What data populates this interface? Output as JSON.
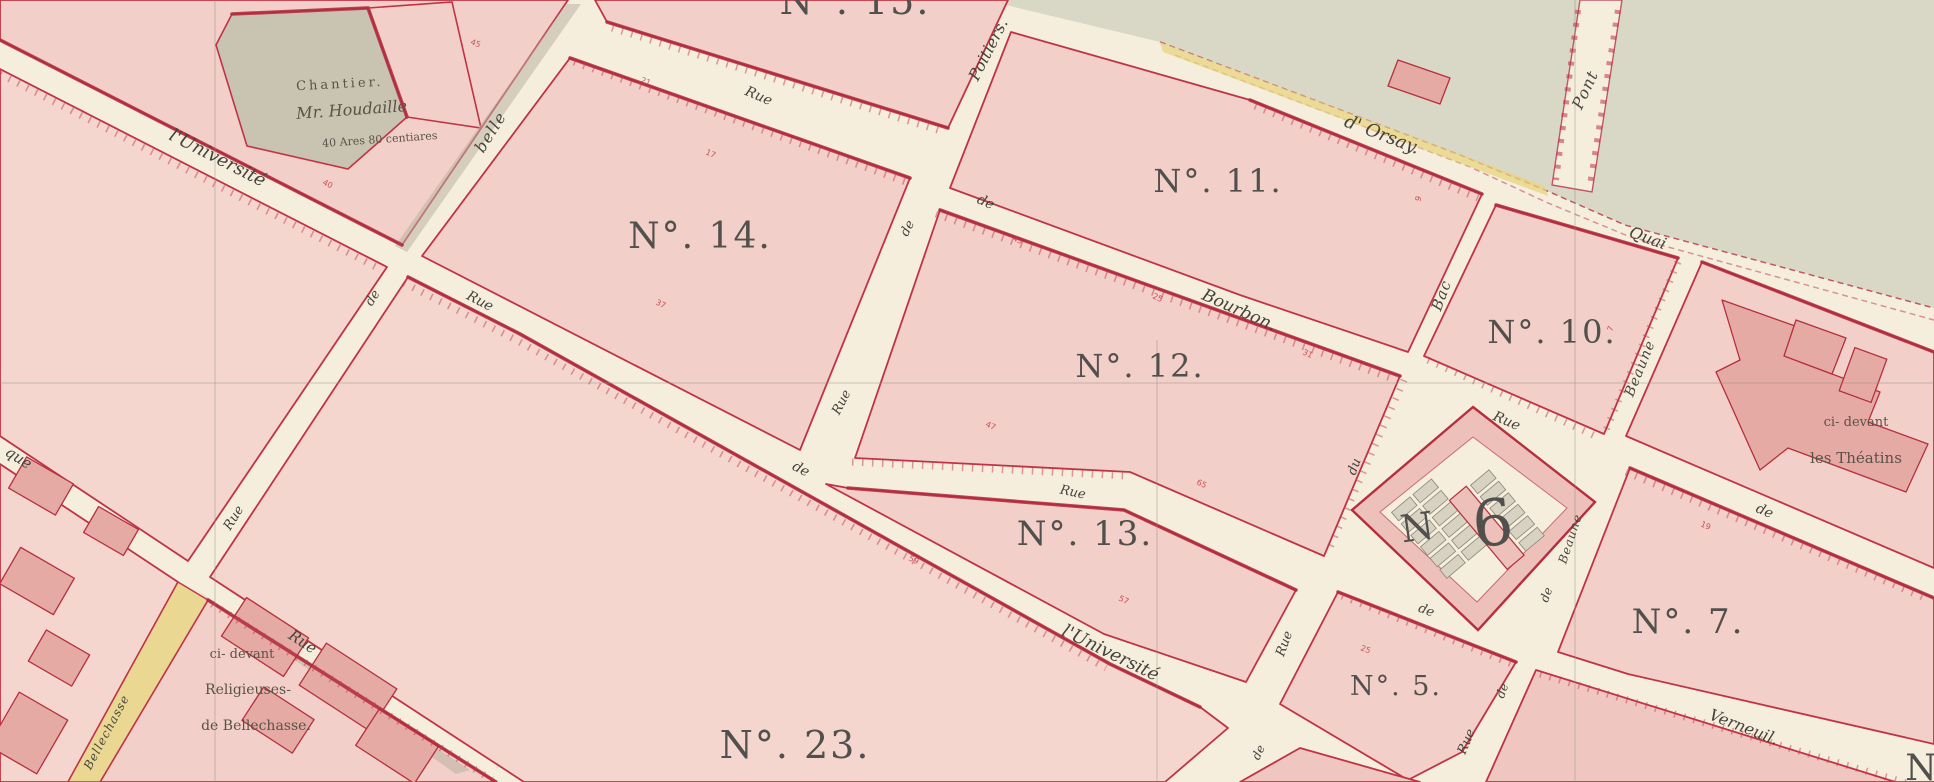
{
  "map": {
    "type": "historic-cadastral-map",
    "colors": {
      "street": "#f5eedd",
      "block_fill": "#f2cfc8",
      "border_carmine": "#c03345",
      "water": "#d9d8c6",
      "grey_parcel": "#c9c3b2",
      "yellow_road": "#ead792",
      "building": "#e5aaa4",
      "number_ink": "#52504c",
      "survey_red": "#c43a45"
    },
    "block_numbers": [
      {
        "id": "15",
        "text": "N°. 15."
      },
      {
        "id": "14",
        "text": "N°. 14."
      },
      {
        "id": "11",
        "text": "N°. 11."
      },
      {
        "id": "12",
        "text": "N°. 12."
      },
      {
        "id": "10",
        "text": "N°. 10."
      },
      {
        "id": "13",
        "text": "N°. 13."
      },
      {
        "id": "23",
        "text": "N°. 23."
      },
      {
        "id": "5",
        "text": "N°. 5."
      },
      {
        "id": "7",
        "text": "N°. 7."
      },
      {
        "id": "6_letter",
        "text": "N"
      },
      {
        "id": "6_digit",
        "text": "6"
      },
      {
        "id": "edge_partial",
        "text": "N"
      }
    ],
    "street_labels": [
      {
        "text": "l'Université"
      },
      {
        "text": "Rue"
      },
      {
        "text": "de"
      },
      {
        "text": "l'Université"
      },
      {
        "text": "Rue"
      },
      {
        "text": "de"
      },
      {
        "text": "Bourbon."
      },
      {
        "text": "Rue"
      },
      {
        "text": "de"
      },
      {
        "text": "belle"
      },
      {
        "text": "de"
      },
      {
        "text": "Rue"
      },
      {
        "text": "Poitiers."
      },
      {
        "text": "de"
      },
      {
        "text": "Rue"
      },
      {
        "text": "d' Orsay."
      },
      {
        "text": "Quai"
      },
      {
        "text": "Pont"
      },
      {
        "text": "Bac"
      },
      {
        "text": "du"
      },
      {
        "text": "Rue"
      },
      {
        "text": "de"
      },
      {
        "text": "Rue"
      },
      {
        "text": "de"
      },
      {
        "text": "Verneuil."
      },
      {
        "text": "Beaune"
      },
      {
        "text": "Beaune"
      },
      {
        "text": "de"
      },
      {
        "text": "Rue"
      },
      {
        "text": "de"
      },
      {
        "text": "que"
      },
      {
        "text": "Rue"
      },
      {
        "text": "Bellechasse"
      }
    ],
    "annotations": {
      "chantier_line1": "Chantier.",
      "chantier_line2": "Mr. Houdaille",
      "chantier_line3": "40 Ares 80 centiares",
      "religieuses_line1": "ci- devant",
      "religieuses_line2": "Religieuses-",
      "religieuses_line3": "de Bellechasse.",
      "theatins_line1": "ci- devant",
      "theatins_line2": "les   Théatins"
    },
    "frontage_numbers": [
      {
        "t": "45"
      },
      {
        "t": "21"
      },
      {
        "t": "17"
      },
      {
        "t": "43"
      },
      {
        "t": "25"
      },
      {
        "t": "31"
      },
      {
        "t": "47"
      },
      {
        "t": "65"
      },
      {
        "t": "59"
      },
      {
        "t": "57"
      },
      {
        "t": "37"
      },
      {
        "t": "40"
      },
      {
        "t": "19"
      },
      {
        "t": "25"
      },
      {
        "t": "9"
      },
      {
        "t": "7"
      }
    ]
  }
}
